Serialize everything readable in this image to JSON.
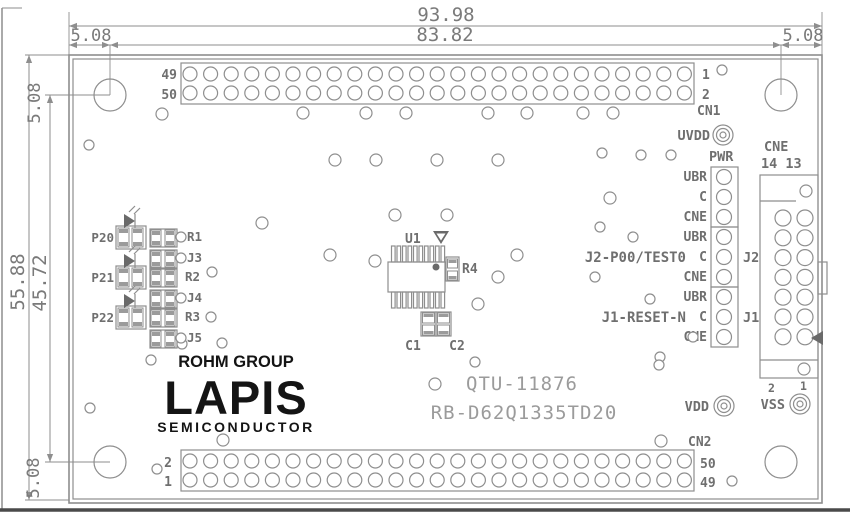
{
  "colors": {
    "line": "#8e8e8e",
    "dim": "#7a7a7a",
    "silk": "#6f6f6f",
    "logo": "#141414",
    "bg": "#ffffff"
  },
  "dimensions": {
    "overall_width": "93.98",
    "pin_span": "83.82",
    "edge_offset": "5.08",
    "overall_height": "55.88",
    "hole_span": "45.72"
  },
  "connectors": {
    "cn1": {
      "name": "CN1",
      "rows": 2,
      "cols": 25,
      "left_top": "49",
      "left_bottom": "50",
      "right_top": "1",
      "right_bottom": "2"
    },
    "cn2": {
      "name": "CN2",
      "rows": 2,
      "cols": 25,
      "left_top": "2",
      "left_bottom": "1",
      "right_top": "50",
      "right_bottom": "49"
    },
    "cne": {
      "name": "CNE",
      "rows": 7,
      "cols": 2,
      "col_labels": "14 13",
      "bottom_pin_2": "2",
      "bottom_pin_1": "1"
    }
  },
  "headers": {
    "pwr": {
      "label": "PWR",
      "pins": [
        "UBR",
        "C",
        "CNE"
      ]
    },
    "j2": {
      "designator": "J2",
      "signal": "J2-P00/TEST0",
      "pins": [
        "UBR",
        "C",
        "CNE"
      ]
    },
    "j1": {
      "designator": "J1",
      "signal": "J1-RESET-N",
      "pins": [
        "UBR",
        "C",
        "CNE"
      ]
    }
  },
  "test_points": {
    "uvdd": "UVDD",
    "vdd": "VDD",
    "vss": "VSS"
  },
  "components": {
    "leds": [
      "P20",
      "P21",
      "P22"
    ],
    "passives": [
      "R1",
      "J3",
      "R2",
      "J4",
      "R3",
      "J5"
    ],
    "ic": "U1",
    "res": "R4",
    "cap1": "C1",
    "cap2": "C2"
  },
  "branding": {
    "group": "ROHM GROUP",
    "name": "LAPIS",
    "subtitle": "SEMICONDUCTOR"
  },
  "ids": {
    "assembly": "QTU-11876",
    "board": "RB-D62Q1335TD20"
  }
}
